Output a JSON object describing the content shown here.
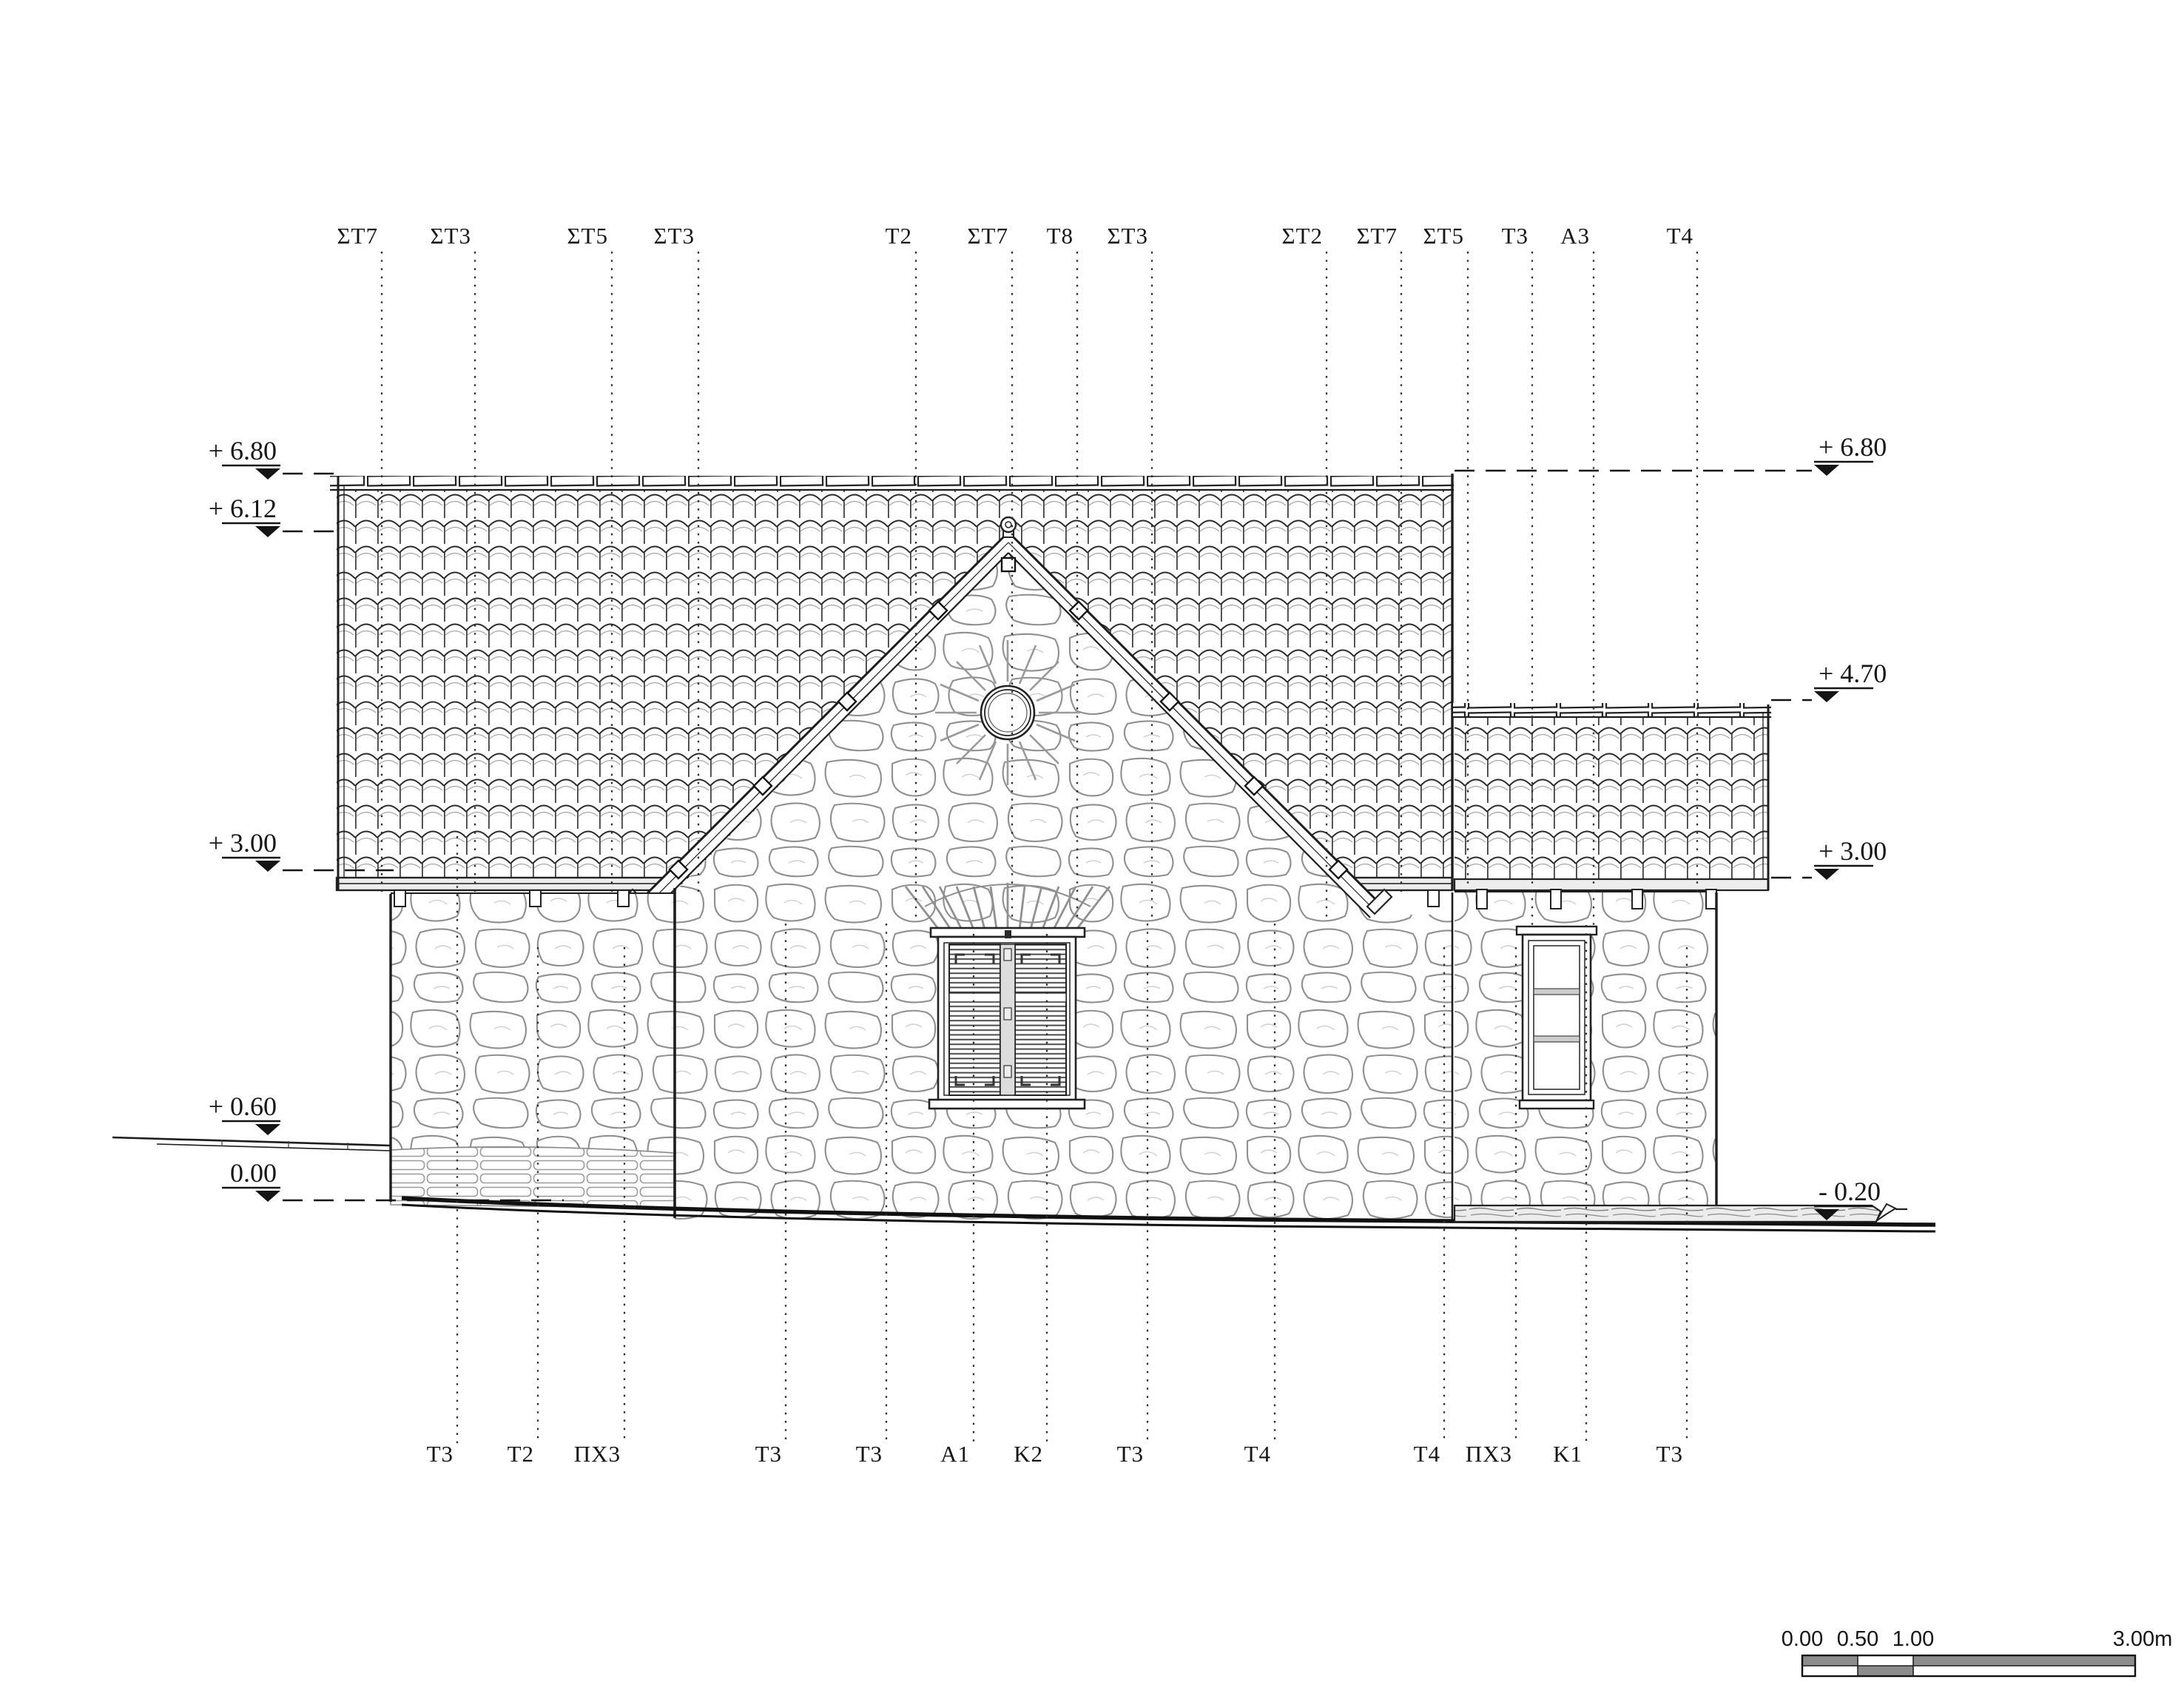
{
  "sheet": {
    "type": "architectural elevation drawing",
    "units": "m"
  },
  "grid": {
    "top": [
      "ΣΤ7",
      "ΣΤ3",
      "ΣΤ5",
      "ΣΤ3",
      "Τ2",
      "ΣΤ7",
      "Τ8",
      "ΣΤ3",
      "ΣΤ2",
      "ΣΤ7",
      "ΣΤ5",
      "Τ3",
      "Α3",
      "Τ4"
    ],
    "bottom": [
      "Τ3",
      "Τ2",
      "ΠΧ3",
      "Τ3",
      "Τ3",
      "Α1",
      "Κ2",
      "Τ3",
      "Τ4",
      "Τ4",
      "ΠΧ3",
      "Κ1",
      "Τ3"
    ]
  },
  "levels": {
    "left": [
      "+ 6.80",
      "+ 6.12",
      "+ 3.00",
      "+ 0.60",
      "0.00"
    ],
    "right": [
      "+ 6.80",
      "+ 4.70",
      "+ 3.00",
      "- 0.20"
    ]
  },
  "scalebar": {
    "t0": "0.00",
    "t1": "0.50",
    "t2": "1.00",
    "t3": "3.00m"
  },
  "colors": {
    "line": "#1d1d1d",
    "stone_joint": "#8f8f8f",
    "scale_gray": "#8c8c8c",
    "paper": "#ffffff"
  }
}
